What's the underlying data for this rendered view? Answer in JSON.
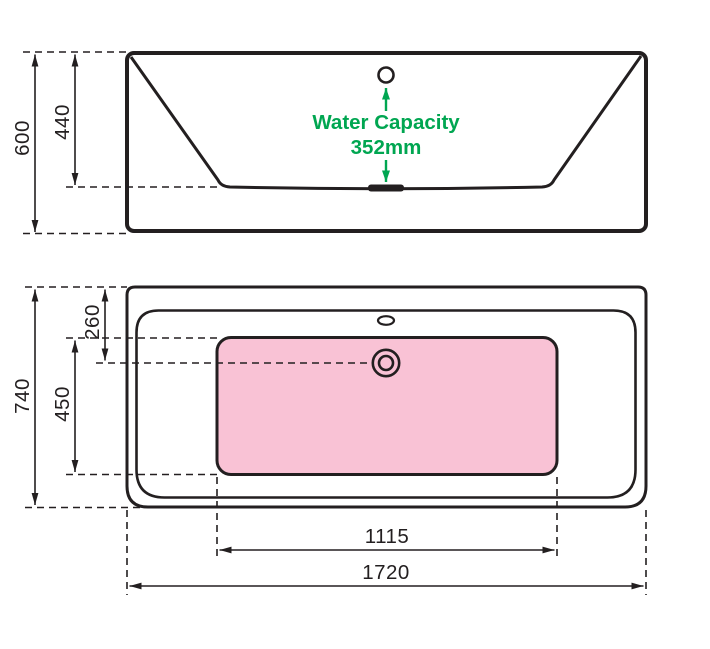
{
  "page": {
    "background": "#ffffff",
    "description": "Technical dimension drawing of a bathtub: side elevation (top) and plan view (bottom)"
  },
  "colors": {
    "line": "#231f20",
    "green": "#00a651",
    "pink": "#f9c2d5"
  },
  "side_view": {
    "dims": {
      "overall_height": "600",
      "inner_depth": "440"
    },
    "water_capacity": {
      "line1": "Water Capacity",
      "line2": "352mm"
    }
  },
  "plan_view": {
    "dims": {
      "overall_width": "740",
      "basin_width": "450",
      "rim_to_waste": "260",
      "basin_length": "1115",
      "overall_length": "1720"
    }
  }
}
